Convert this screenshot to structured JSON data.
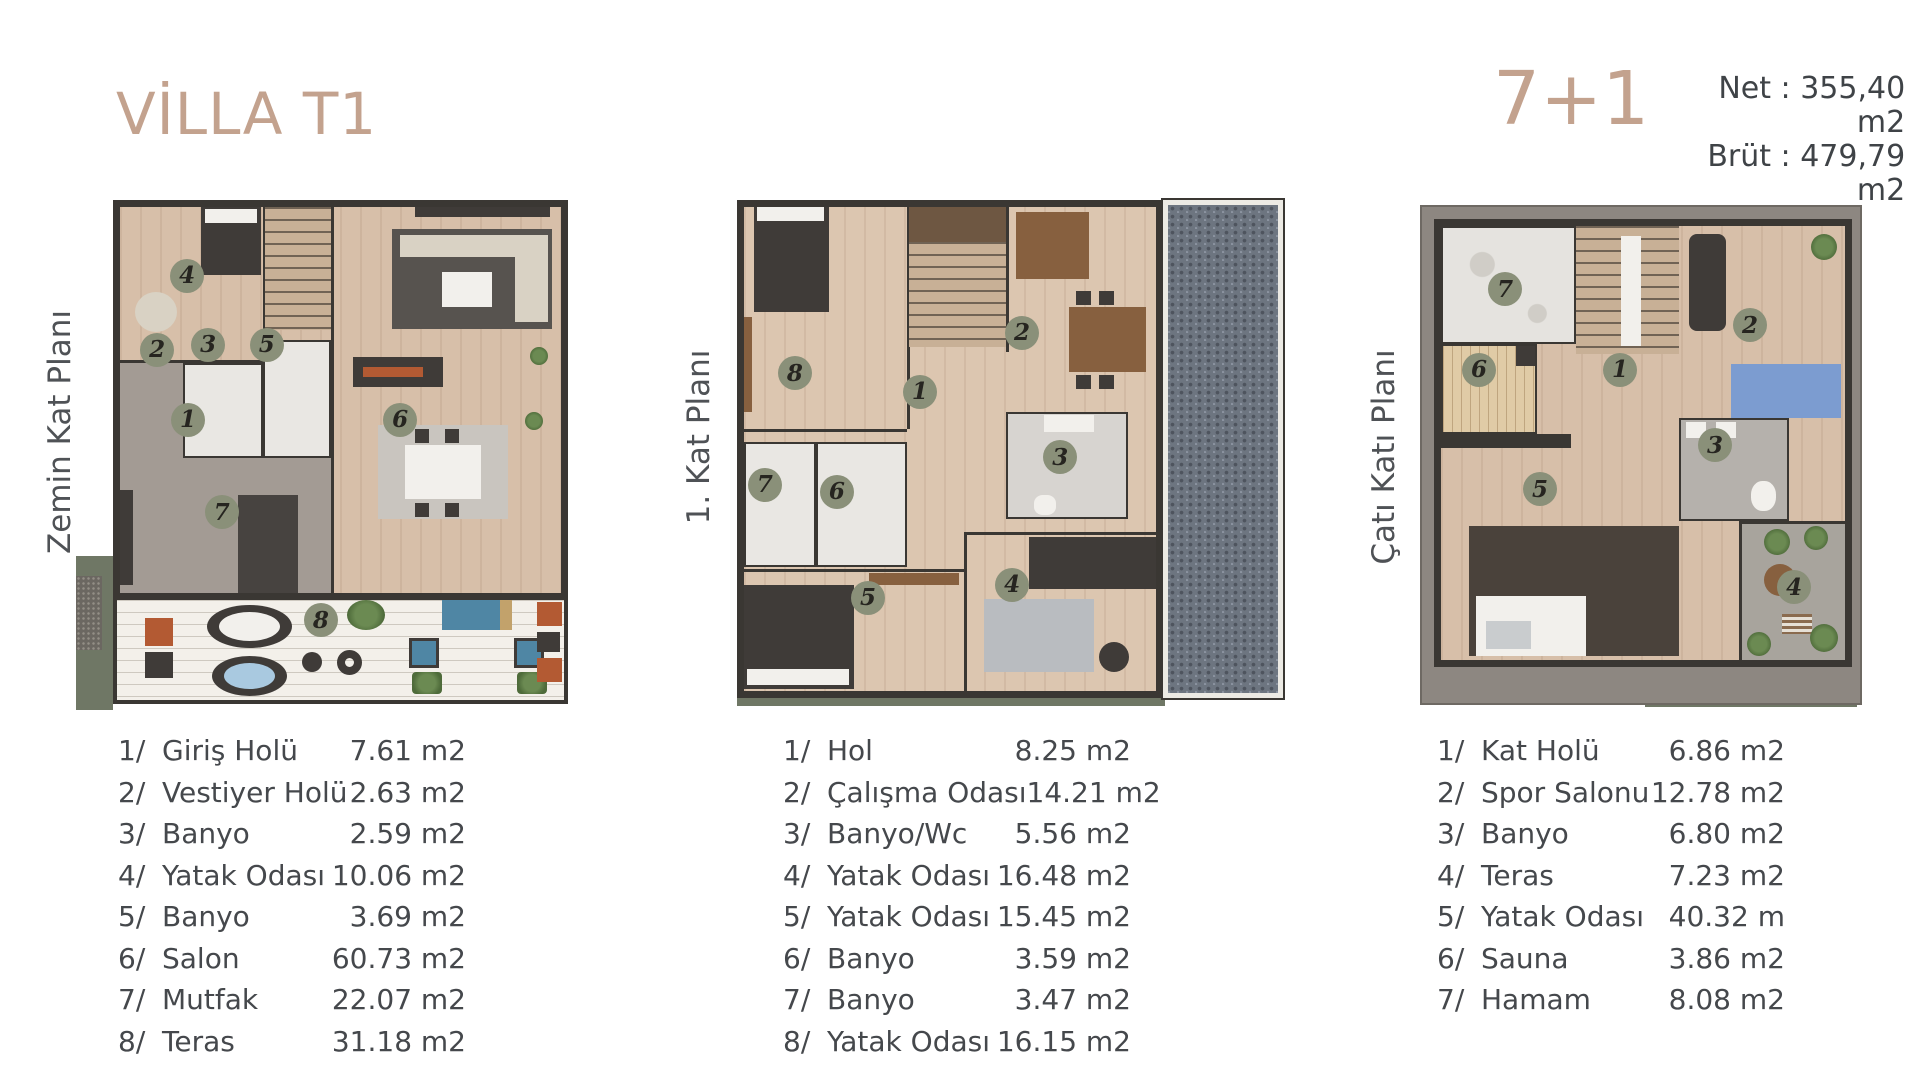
{
  "header": {
    "title": "VİLLA T1",
    "type_label": "7+1",
    "net": "Net : 355,40 m2",
    "brut": "Brüt : 479,79 m2"
  },
  "colors": {
    "accent_tan": "#c3a28e",
    "text_dark": "#3f4347",
    "badge_green": "#8a9079",
    "wall": "#3a3733",
    "wood_floor": "#d7bfa9",
    "gray_floor": "#a39b94",
    "tile_white": "#e9e7e3",
    "terrace_plank": "#f3f0ea",
    "roof_tile": "#6d7580",
    "lawn_olive": "#6f7765"
  },
  "plans": [
    {
      "label": "Zemin Kat Planı",
      "badges": [
        {
          "n": "4",
          "x": 16.3,
          "y": 14.9
        },
        {
          "n": "2",
          "x": 9.7,
          "y": 29.4
        },
        {
          "n": "3",
          "x": 20.9,
          "y": 28.4
        },
        {
          "n": "5",
          "x": 33.8,
          "y": 28.4
        },
        {
          "n": "1",
          "x": 16.5,
          "y": 43.1
        },
        {
          "n": "6",
          "x": 63.1,
          "y": 43.1
        },
        {
          "n": "7",
          "x": 23.9,
          "y": 61.2
        },
        {
          "n": "8",
          "x": 45.7,
          "y": 82.4
        }
      ],
      "rooms": [
        {
          "no": "1/",
          "name": "Giriş Holü",
          "area": "7.61 m2"
        },
        {
          "no": "2/",
          "name": "Vestiyer Holü",
          "area": "2.63 m2"
        },
        {
          "no": "3/",
          "name": "Banyo",
          "area": "2.59 m2"
        },
        {
          "no": "4/",
          "name": "Yatak Odası",
          "area": "10.06 m2"
        },
        {
          "no": "5/",
          "name": "Banyo",
          "area": "3.69 m2"
        },
        {
          "no": "6/",
          "name": "Salon",
          "area": "60.73 m2"
        },
        {
          "no": "7/",
          "name": "Mutfak",
          "area": "22.07 m2"
        },
        {
          "no": "8/",
          "name": "Teras",
          "area": "31.18 m2"
        }
      ]
    },
    {
      "label": "1. Kat Planı",
      "badges": [
        {
          "n": "8",
          "x": 10.6,
          "y": 34.3
        },
        {
          "n": "2",
          "x": 52.2,
          "y": 26.3
        },
        {
          "n": "1",
          "x": 33.5,
          "y": 38.0
        },
        {
          "n": "3",
          "x": 59.2,
          "y": 50.9
        },
        {
          "n": "7",
          "x": 5.1,
          "y": 56.4
        },
        {
          "n": "6",
          "x": 18.3,
          "y": 57.8
        },
        {
          "n": "5",
          "x": 24.0,
          "y": 78.8
        },
        {
          "n": "4",
          "x": 50.4,
          "y": 76.2
        }
      ],
      "rooms": [
        {
          "no": "1/",
          "name": "Hol",
          "area": "8.25 m2"
        },
        {
          "no": "2/",
          "name": "Çalışma Odası",
          "area": "14.21 m2"
        },
        {
          "no": "3/",
          "name": "Banyo/Wc",
          "area": "5.56 m2"
        },
        {
          "no": "4/",
          "name": "Yatak Odası",
          "area": "16.48 m2"
        },
        {
          "no": "5/",
          "name": "Yatak Odası",
          "area": "15.45 m2"
        },
        {
          "no": "6/",
          "name": "Banyo",
          "area": "3.59 m2"
        },
        {
          "no": "7/",
          "name": "Banyo",
          "area": "3.47 m2"
        },
        {
          "no": "8/",
          "name": "Yatak Odası",
          "area": "16.15 m2"
        }
      ]
    },
    {
      "label": "Çatı Katı Planı",
      "badges": [
        {
          "n": "7",
          "x": 18.8,
          "y": 16.4
        },
        {
          "n": "2",
          "x": 74.2,
          "y": 23.6
        },
        {
          "n": "6",
          "x": 12.9,
          "y": 32.6
        },
        {
          "n": "1",
          "x": 44.8,
          "y": 32.6
        },
        {
          "n": "3",
          "x": 66.3,
          "y": 47.6
        },
        {
          "n": "5",
          "x": 26.7,
          "y": 56.4
        },
        {
          "n": "4",
          "x": 84.2,
          "y": 76.0
        }
      ],
      "rooms": [
        {
          "no": "1/",
          "name": "Kat Holü",
          "area": "6.86 m2"
        },
        {
          "no": "2/",
          "name": "Spor Salonu",
          "area": "12.78 m2"
        },
        {
          "no": "3/",
          "name": "Banyo",
          "area": "6.80 m2"
        },
        {
          "no": "4/",
          "name": "Teras",
          "area": "7.23 m2"
        },
        {
          "no": "5/",
          "name": "Yatak Odası",
          "area": "40.32 m"
        },
        {
          "no": "6/",
          "name": "Sauna",
          "area": "3.86 m2"
        },
        {
          "no": "7/",
          "name": "Hamam",
          "area": "8.08 m2"
        }
      ]
    }
  ]
}
